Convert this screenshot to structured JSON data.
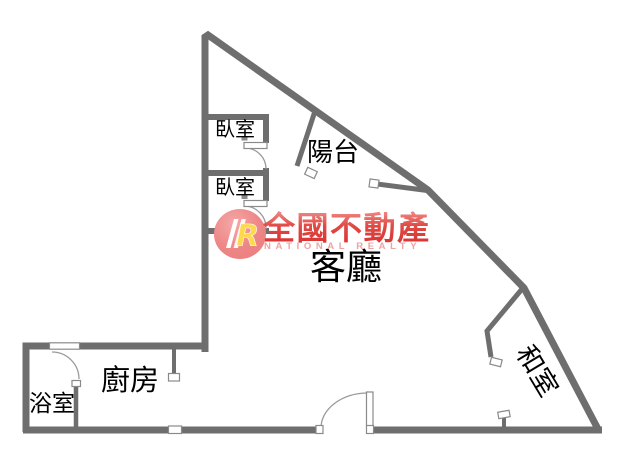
{
  "floorplan": {
    "title": "apartment-floor-plan",
    "rooms": [
      {
        "name": "bedroom-1",
        "label": "臥室"
      },
      {
        "name": "bedroom-2",
        "label": "臥室"
      },
      {
        "name": "balcony",
        "label": "陽台"
      },
      {
        "name": "living-room",
        "label": "客廳"
      },
      {
        "name": "kitchen",
        "label": "廚房"
      },
      {
        "name": "bathroom",
        "label": "浴室"
      },
      {
        "name": "tatami-room",
        "label": "和室"
      }
    ]
  },
  "watermark": {
    "monogram": "R",
    "brand_name": "全國不動產",
    "brand_name_en": "NATIONAL REALTY"
  },
  "colors": {
    "wall_gray": "#6e6e6e",
    "door_line_gray": "#9a9a9a",
    "marker_border_gray": "#8a8a8a",
    "label_black": "#000000",
    "logo_circle_pink": "#ee8686",
    "monogram_yellow": "#ffd84d",
    "brand_red": "#d93131",
    "brand_pink_light": "#f2918e",
    "brand_en_pink": "#eda3a3"
  }
}
